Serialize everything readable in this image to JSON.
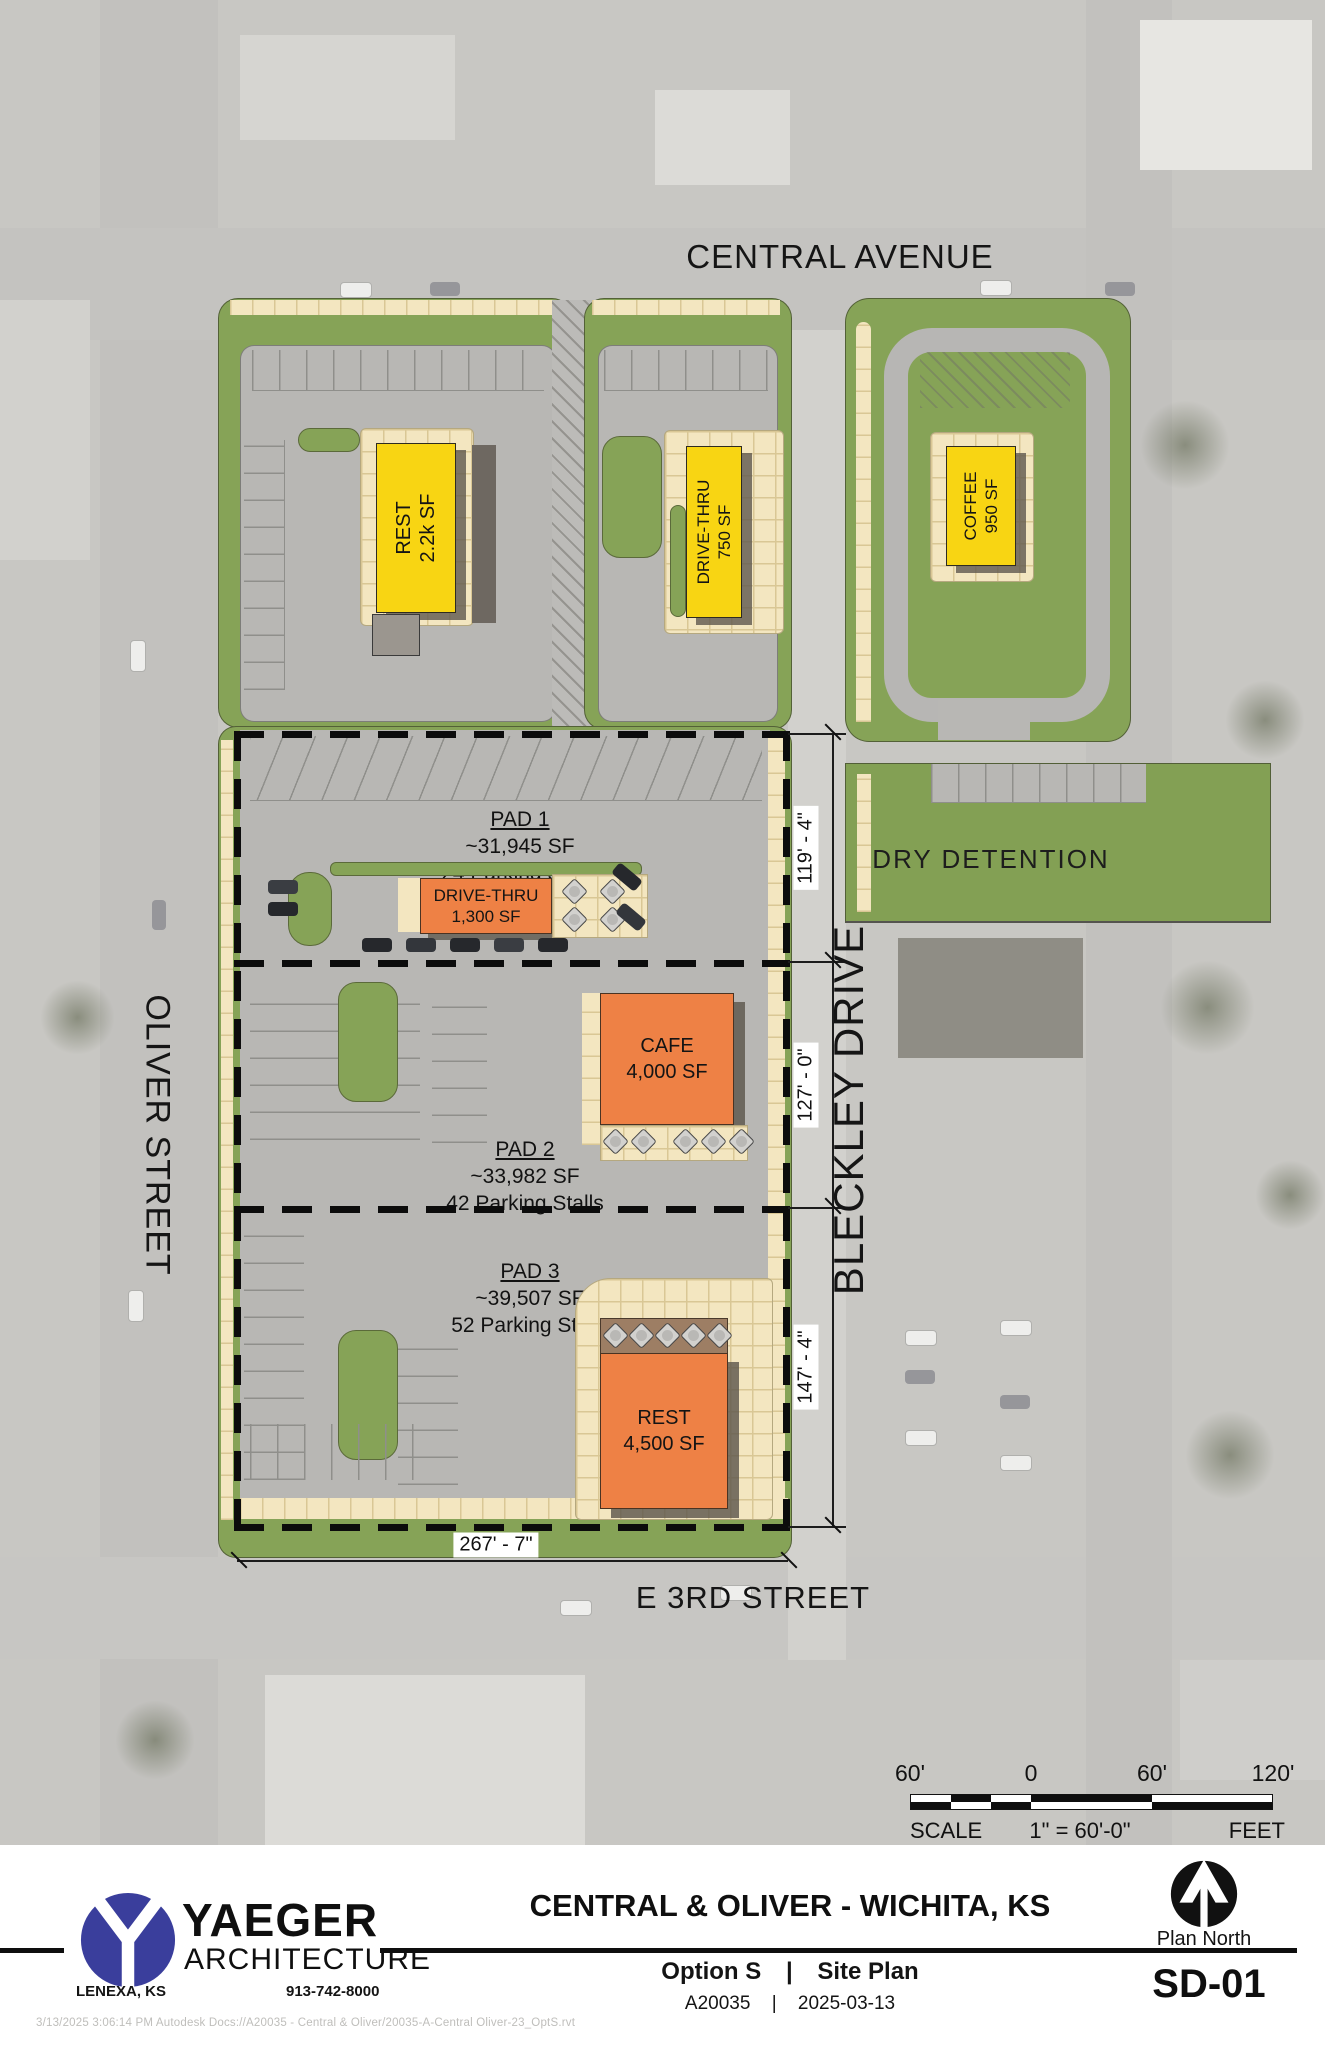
{
  "streets": {
    "central_avenue": "CENTRAL AVENUE",
    "oliver_street": "OLIVER STREET",
    "bleckley_drive": "BLECKLEY DRIVE",
    "e_3rd_street": "E 3RD STREET"
  },
  "buildings": {
    "rest_small": {
      "name": "REST",
      "size": "2.2k SF"
    },
    "drive_thru_small": {
      "name": "DRIVE-THRU",
      "size": "750 SF"
    },
    "coffee": {
      "name": "COFFEE",
      "size": "950 SF"
    },
    "drive_thru_pad1": {
      "name": "DRIVE-THRU",
      "size": "1,300 SF"
    },
    "cafe": {
      "name": "CAFE",
      "size": "4,000 SF"
    },
    "rest_large": {
      "name": "REST",
      "size": "4,500 SF"
    }
  },
  "pads": [
    {
      "name": "PAD 1",
      "area": "~31,945 SF",
      "stalls": "24 Parking Stalls"
    },
    {
      "name": "PAD 2",
      "area": "~33,982 SF",
      "stalls": "42 Parking Stalls"
    },
    {
      "name": "PAD 3",
      "area": "~39,507 SF",
      "stalls": "52 Parking Stalls"
    }
  ],
  "detention": {
    "label": "DRY DETENTION"
  },
  "dimensions": {
    "pad1_depth": "119' - 4\"",
    "pad2_depth": "127' - 0\"",
    "pad3_depth": "147' - 4\"",
    "site_width": "267' - 7\""
  },
  "scale_bar": {
    "tick_60_left": "60'",
    "tick_0": "0",
    "tick_60_right": "60'",
    "tick_120": "120'",
    "scale_word": "SCALE",
    "ratio": "1\" = 60'-0\"",
    "units_word": "FEET"
  },
  "title_block": {
    "firm_name": "YAEGER",
    "firm_type": "ARCHITECTURE",
    "firm_city": "LENEXA, KS",
    "firm_phone": "913-742-8000",
    "project_title": "CENTRAL & OLIVER - WICHITA, KS",
    "option_label": "Option S",
    "separator": "|",
    "sheet_name": "Site Plan",
    "project_number": "A20035",
    "date": "2025-03-13",
    "north_label": "Plan North",
    "sheet_number": "SD-01"
  },
  "footer": {
    "path_note": "3/13/2025 3:06:14 PM  Autodesk Docs://A20035 - Central & Oliver/20035-A-Central Oliver-23_OptS.rvt"
  },
  "colors": {
    "landscape_green": "#86a357",
    "pavement_gray": "#b8b7b4",
    "sidewalk_cream": "#f3e6c0",
    "building_yellow": "#f8d513",
    "building_orange": "#ee8145",
    "logo_blue": "#3a3e9c"
  }
}
